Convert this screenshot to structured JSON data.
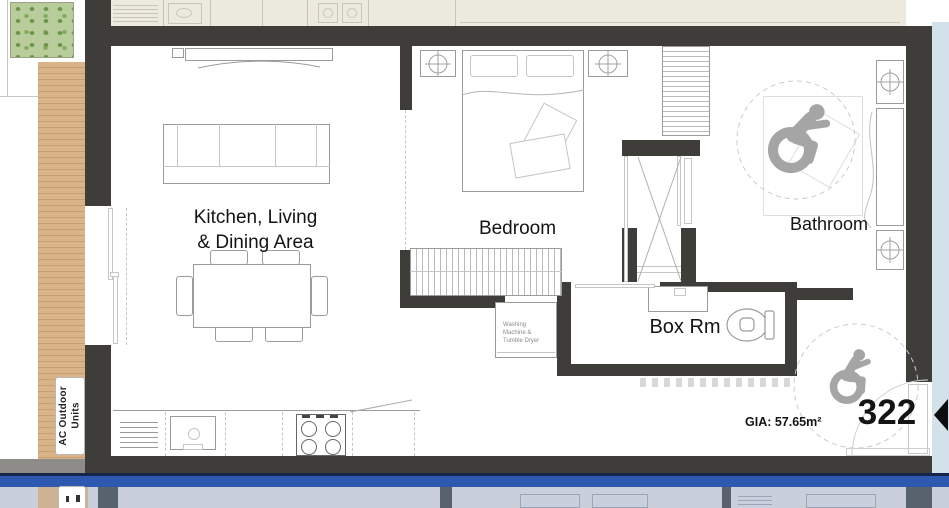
{
  "unit": {
    "number": "322",
    "gia": "GIA: 57.65m²"
  },
  "rooms": {
    "kitchen_living": "Kitchen, Living\n& Dining Area",
    "bedroom": "Bedroom",
    "bathroom": "Bathroom",
    "box_room": "Box Rm",
    "washing": "Washing\nMachine &\nTumble Dryer",
    "ac_units": "AC Outdoor\nUnits"
  },
  "icons": {
    "bathroom_symbol": "wheelchair-accessible",
    "entry_symbol": "wheelchair-accessible",
    "entry_marker": "entry-arrow"
  },
  "colors": {
    "wall": "#3e3d3a",
    "deck": "#d8b488",
    "deck-line": "#c6a072",
    "planting": "#b9cd9c",
    "planting-dot": "#6d9549",
    "neighbor": "#ece9df",
    "neighbor-line": "#c9c6b8",
    "corridor": "#d3e1eb",
    "band": "#2e59b0",
    "band-edge": "#16254b",
    "dim-bg": "#c9cfdb",
    "dim-line": "#9aa5ba",
    "dim-wall": "#59626f",
    "stroke": "#9b9b9b",
    "stroke-light": "#c6c6c6",
    "symbol": "#a5a5a5",
    "text": "#141414"
  }
}
